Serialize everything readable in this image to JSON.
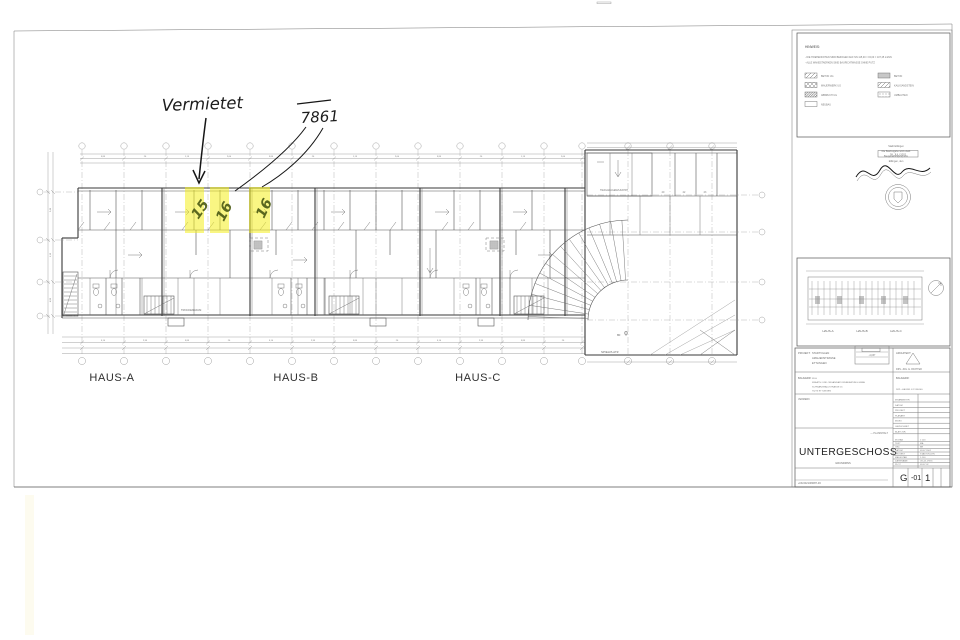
{
  "annotations": {
    "vermietet_label": "Vermietet",
    "price_label": "7861",
    "unit_numbers": [
      "15",
      "16",
      "16"
    ]
  },
  "plan": {
    "haus_labels": [
      "HAUS-A",
      "HAUS-B",
      "HAUS-C"
    ],
    "spielplatz_label": "SPIELPLATZ",
    "trockenraum_label": "TROCKENRAUM",
    "garage_label": "TIEFGARAGENZUFAHRT",
    "garage_cell_numbers": [
      "20",
      "22",
      "23"
    ],
    "area_mark": "80",
    "dim_tokens_top": [
      "3,85",
      "26",
      "1,15",
      "2,60"
    ],
    "dim_tokens_bottom": [
      "5,10",
      "2,35",
      "3,85",
      "26"
    ],
    "dim_tokens_left": [
      "2,40",
      "1,15",
      "4,85"
    ]
  },
  "legend": {
    "title": "HINWEIS:",
    "notes": [
      "- DIE HOEHENKOTEN SIND BEZOGEN AUF NN 115,00 = ±0,00 = 107,25 müNN",
      "- ALLE WANDSTAERKEN SIND BAURICHTMASSE OHNE PUTZ"
    ],
    "items_left": [
      "BETON UG",
      "MAUERWERK UG",
      "ABBRUCH UG",
      "NEUBAU"
    ],
    "items_right": [
      "BETON",
      "KALKSANDSTEIN",
      "UMBAUTEN"
    ]
  },
  "stamp": {
    "lines": [
      "Stadt Ettlingen",
      "Die Baufreigabe wird erteilt",
      "Baugenehmigung vom",
      "Ettlingen, den"
    ],
    "date": "09. JULI 2002"
  },
  "keyplan": {
    "haus_labels": [
      "HAUS-A",
      "HAUS-B",
      "HAUS-C"
    ]
  },
  "titleblock": {
    "projekt_label": "PROJEKT:",
    "projekt_lines": [
      "STADTVILLEN",
      "AMALIENSTRASSE",
      "ETTLINGEN"
    ],
    "level_value": "-4,037",
    "architekt_label": "ARCHITEKT:",
    "architekt_name": "DIPL.-ING. E. RICHTER",
    "bauherr_label": "BAUHERR:",
    "bauherr_lines": [
      "WLH",
      "KREATIV- UND ORGANISATIONSBERATUNG GMBH",
      "SCHWARZWALDSTRASSE 16",
      "76275 ETTLINGEN"
    ],
    "bauherr2_label": "BAUHERR:",
    "bauherr2_name": "DIPL.-KAUFM. K.P. REGEL",
    "vermerk_label": "VERMERK",
    "index_rows": [
      "MITARBEITER",
      "DATUM",
      "PROJEKT",
      "PLANART",
      "INDEX",
      "GEZEICHNET",
      "BLATT-NR."
    ],
    "info_rows": [
      [
        "M.STAB",
        "1:100"
      ],
      [
        "TEXT",
        "MA"
      ],
      [
        "GEZ.",
        "BR"
      ],
      [
        "DATUM",
        "09.07.2002"
      ],
      [
        "PROJEKT",
        "STADTVILLEN"
      ],
      [
        "MASSSTAB",
        "1:100"
      ],
      [
        "DATEINAME",
        "UG-01.DWG"
      ],
      [
        "PLOT",
        "09.07.02"
      ]
    ],
    "plan_title": "UNTERGESCHOSS",
    "plan_subtitle": "GRUNDRISS",
    "plan_note": "— PLANINHALT",
    "doc_number": "+NU/0/21/06087-33",
    "sheet_code": [
      "G",
      "-01",
      "1"
    ]
  }
}
